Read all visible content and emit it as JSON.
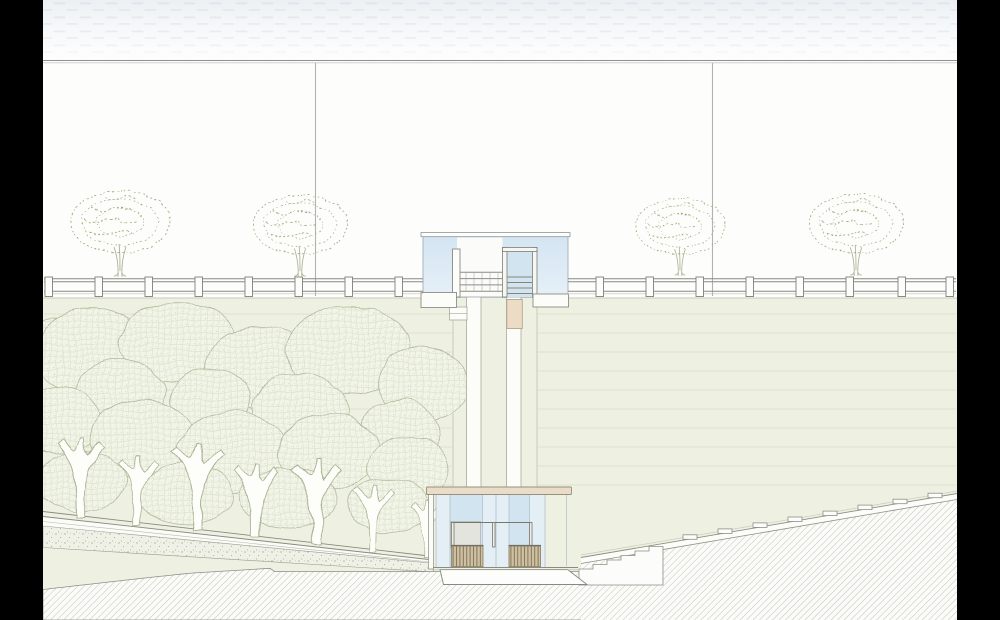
{
  "scene": {
    "description": "Architectural section drawing: street promenade with guardrail and trees above a planted embankment, elevator/stair tower connecting to a lower glass pavilion, forest on left slope, stairs and step blocks on right slope, hatched ground",
    "street_level": {
      "street_trees": 4,
      "guardrail_posts_left": 8,
      "guardrail_posts_right": 8,
      "light_poles": 2
    },
    "embankment": {
      "contour_lines": 10
    },
    "tower": {
      "shaft_strips": 2,
      "elevator_car": 1
    },
    "lower_pavilion": {
      "benches": 2,
      "glass_strips": 2
    },
    "right_slope": {
      "stair_steps": 6,
      "step_blocks": 8
    },
    "forest": {
      "tree_trunks": 7
    }
  },
  "colors": {
    "letterbox": "#000000",
    "paper": "#fdfdfc",
    "sky_band": "#eef2f6",
    "sky_dash": "#dce4ea",
    "frame_line": "#8f8f8f",
    "embankment": "#eef1e2",
    "embankment_line": "#dde1cc",
    "glass_light": "#e4eef5",
    "glass_dark": "#d2e4f0",
    "roof_beige": "#e9dcc8",
    "elevator_car_beige": "#ecdcc6",
    "bench_tan": "#cec0a2",
    "bench_slat_line": "#7b6c50",
    "hatch_line": "#b5b5b3",
    "foliage_stroke": "#9cab75",
    "forest_outline": "#b2ba9d",
    "forest_fill": "#f1f4e7",
    "trunk_stroke": "#a9b193",
    "fence_stroke": "#8a8a82",
    "white_structure": "#fcfcf9"
  }
}
